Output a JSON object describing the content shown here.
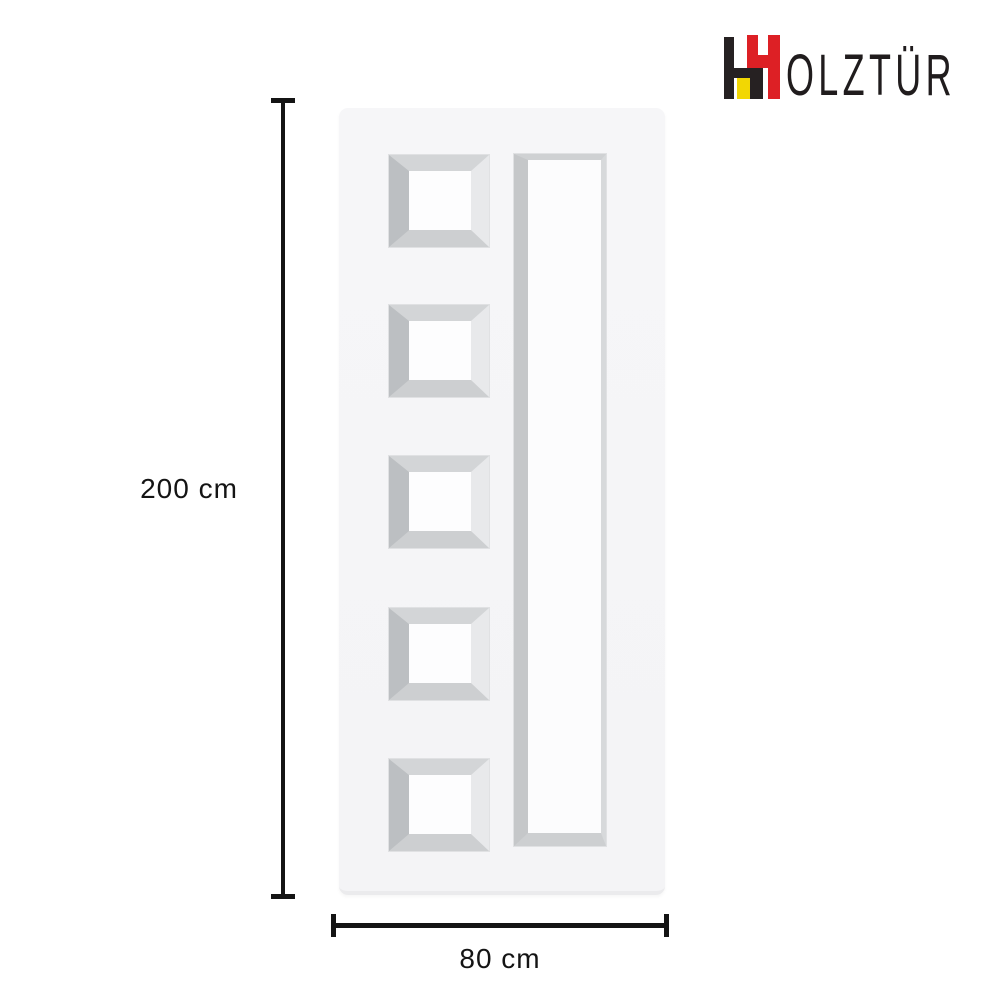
{
  "brand": {
    "name": "HOLZTÜR",
    "wordmark_text": "OLZTÜR",
    "icon": "holztur-h-monogram",
    "icon_colors": {
      "dark": "#262122",
      "red": "#dd2025",
      "yellow": "#f2d703"
    }
  },
  "product": {
    "illustration": "white panel door, front view",
    "door_face_color": "#f5f5f7",
    "square_panel_count": 5,
    "tall_panel_count": 1
  },
  "dimensions": {
    "height_label": "200 cm",
    "width_label": "80 cm",
    "line_color": "#141414"
  }
}
